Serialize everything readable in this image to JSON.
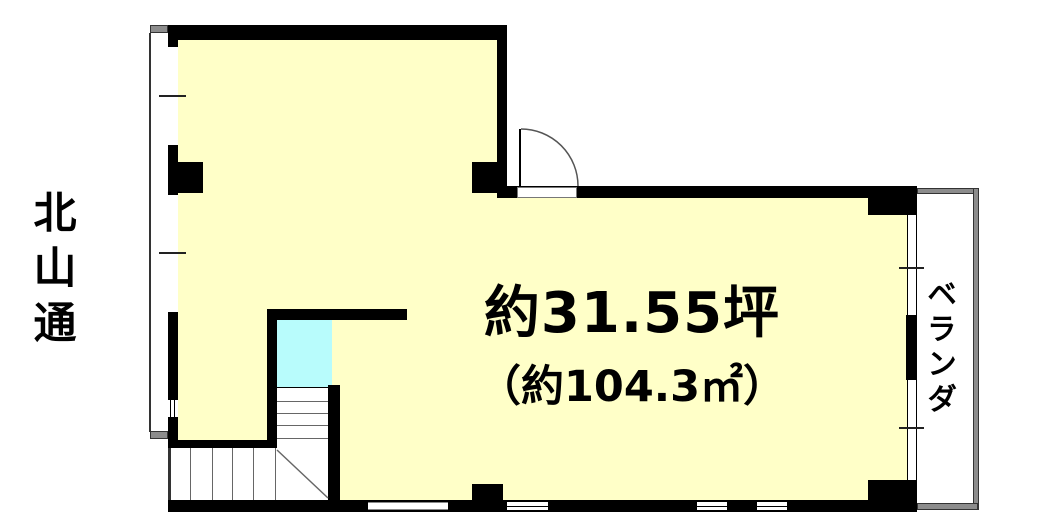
{
  "page": {
    "type": "floor-plan",
    "width_px": 1044,
    "height_px": 532
  },
  "labels": {
    "street": "北山通",
    "veranda": "ベランダ",
    "area_tsubo": "約31.55坪",
    "area_sqm": "（約104.3㎡）"
  },
  "rooms": [
    {
      "name": "main-room",
      "area_tsubo": "約31.55坪",
      "area_sqm": "約104.3㎡"
    },
    {
      "name": "stairwell-void"
    },
    {
      "name": "staircase"
    },
    {
      "name": "veranda",
      "label": "ベランダ"
    }
  ],
  "features": [
    "door-swing-arc",
    "windows-left-wall",
    "windows-right-wall",
    "windows-bottom-wall",
    "l-shaped-staircase"
  ],
  "colors": {
    "room_fill": "#FFFFC8",
    "stairwell_fill": "#B8FCFC",
    "wall": "#000000",
    "veranda_edge": "#8C8C8C",
    "background": "#FFFFFF",
    "text": "#000000"
  }
}
